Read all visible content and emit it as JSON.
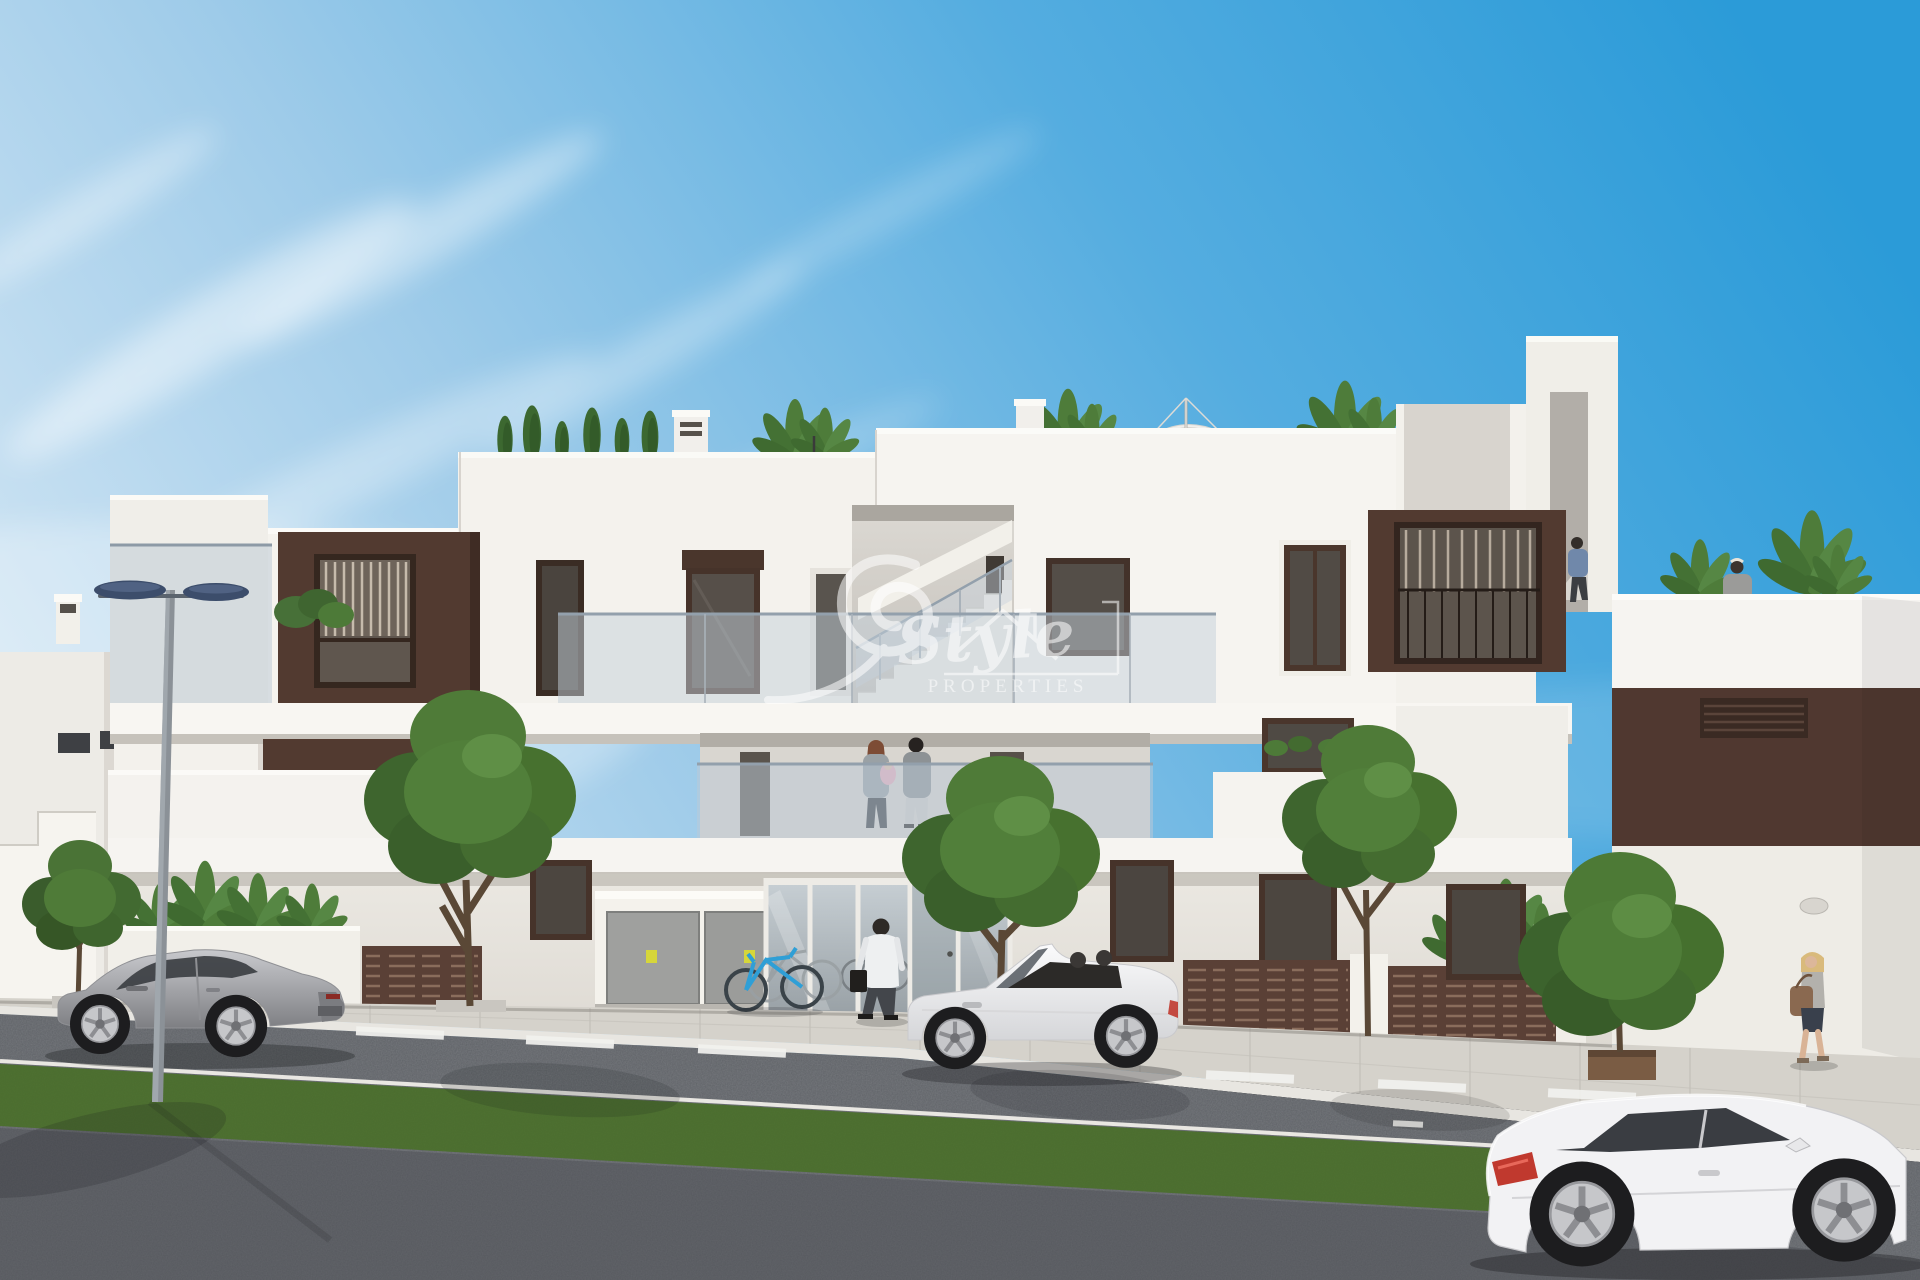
{
  "watermark": {
    "brand_script": "Style",
    "tagline": "PROPERTIES"
  },
  "palette": {
    "sky_top": "#2b9bd8",
    "sky_horizon": "#dcebf6",
    "facade_white": "#f4f2ee",
    "accent_brown": "#523a30",
    "window_frame": "#46332a",
    "balustrade_glass": "#bcc9d6",
    "sidewalk": "#d5d2cb",
    "asphalt": "#5f6267",
    "grass": "#4b6d2e",
    "foliage": "#4f7b38",
    "lamp_head": "#3c4d6b",
    "bicycle_blue": "#2f9fd6",
    "car_silver": "#a9abaf",
    "car_white": "#f2f2f4",
    "taillight_red": "#c0392e",
    "sticker_yellow": "#d6d63a"
  },
  "scene": {
    "setting": "modern-apartment-building-street-render",
    "vehicles": [
      {
        "name": "silver-sports-coupe"
      },
      {
        "name": "white-convertible-roadster"
      },
      {
        "name": "white-sports-coupe"
      }
    ],
    "people": [
      {
        "name": "man-walking-to-entrance"
      },
      {
        "name": "couple-with-baby-on-balcony"
      },
      {
        "name": "man-on-roof-stairs"
      },
      {
        "name": "woman-on-roof-terrace"
      },
      {
        "name": "woman-walking-on-sidewalk"
      }
    ],
    "objects": [
      {
        "name": "street-lamp"
      },
      {
        "name": "bicycle-rack"
      },
      {
        "name": "utility-cabinet"
      },
      {
        "name": "roof-parasol"
      },
      {
        "name": "street-trees"
      },
      {
        "name": "privacy-fences"
      }
    ]
  }
}
